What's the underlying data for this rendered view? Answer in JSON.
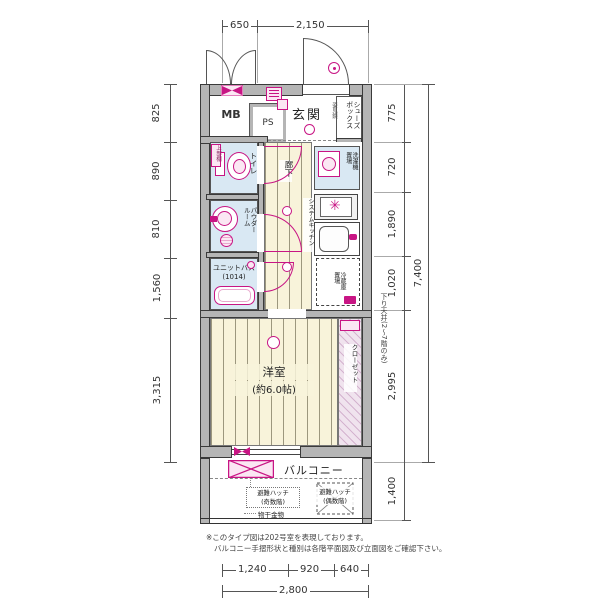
{
  "dims": {
    "top": [
      "650",
      "2,150"
    ],
    "left": [
      "825",
      "890",
      "810",
      "1,560",
      "3,315"
    ],
    "right": [
      "775",
      "720",
      "1,890",
      "1,020",
      "2,995"
    ],
    "right_total": "7,400",
    "balcony_depth": "1,400",
    "bottom": [
      "1,240",
      "920",
      "640"
    ],
    "bottom_total": "2,800"
  },
  "labels": {
    "mb": "MB",
    "ps": "PS",
    "entrance": "玄関",
    "shoe_box": "シューズボックス",
    "mirror": "姿見鏡",
    "toilet": "トイレ",
    "upper_shelf": "上部棚",
    "powder_room": "パウダールーム",
    "unit_bath": "ユニットバス",
    "unit_bath_size": "(1014)",
    "hallway": "廊下",
    "system_kitchen": "システムキッチン",
    "washer": "洗濯機置場",
    "fridge": "冷蔵庫置場",
    "closet": "クローゼット",
    "room": "洋室",
    "room_size": "(約6.0帖)",
    "lowered_ceiling": "下り天井(2〜7階のみ)",
    "balcony": "バルコニー",
    "hatch_odd_1": "避難ハッチ",
    "hatch_odd_2": "(奇数階)",
    "hatch_even_1": "避難ハッチ",
    "hatch_even_2": "(偶数階)",
    "drying_fixture": "物干金物"
  },
  "notes": {
    "line1": "※このタイプ図は202号室を表現しております。",
    "line2": "バルコニー手摺形状と種別は各階平面図及び立面図をご確認下さい。"
  },
  "icons": {
    "burner_glyph": "✳"
  },
  "colors": {
    "accent_pink": "#c81584",
    "wall_gray": "#b5b5b5",
    "floor_cream": "#f8f3da",
    "wet_blue": "#d9e8f3"
  }
}
